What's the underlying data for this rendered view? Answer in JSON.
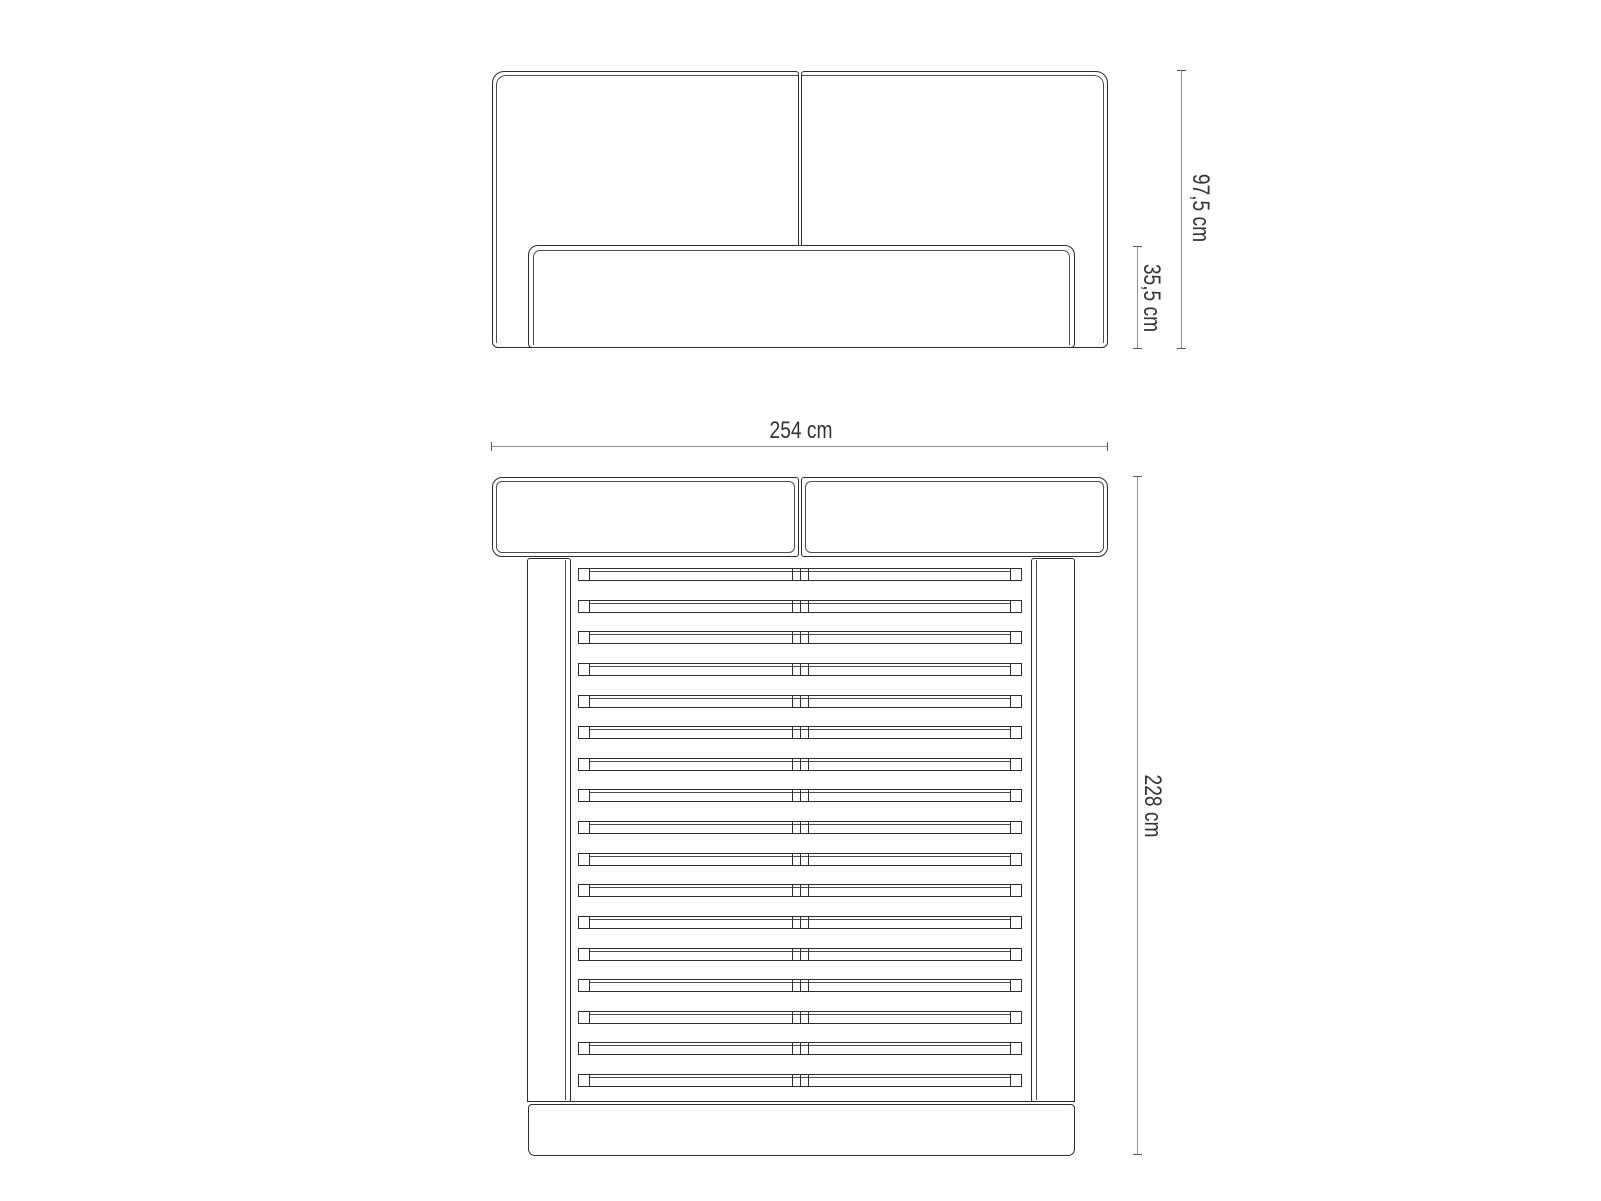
{
  "diagram": {
    "type": "furniture-dimension-drawing",
    "views": {
      "front": {
        "name": "front-elevation",
        "dim_total_height": "97,5 cm",
        "dim_base_height": "35,5 cm"
      },
      "top": {
        "name": "top-plan",
        "dim_width": "254 cm",
        "dim_depth": "228 cm",
        "slat_count": 17
      }
    },
    "colors": {
      "outline": "#2d2d2d",
      "inner_line": "#4d4d4d",
      "dimension_line": "#8c8c8c",
      "dimension_cap": "#5a5a5a",
      "text": "#333333",
      "background": "#ffffff"
    }
  }
}
